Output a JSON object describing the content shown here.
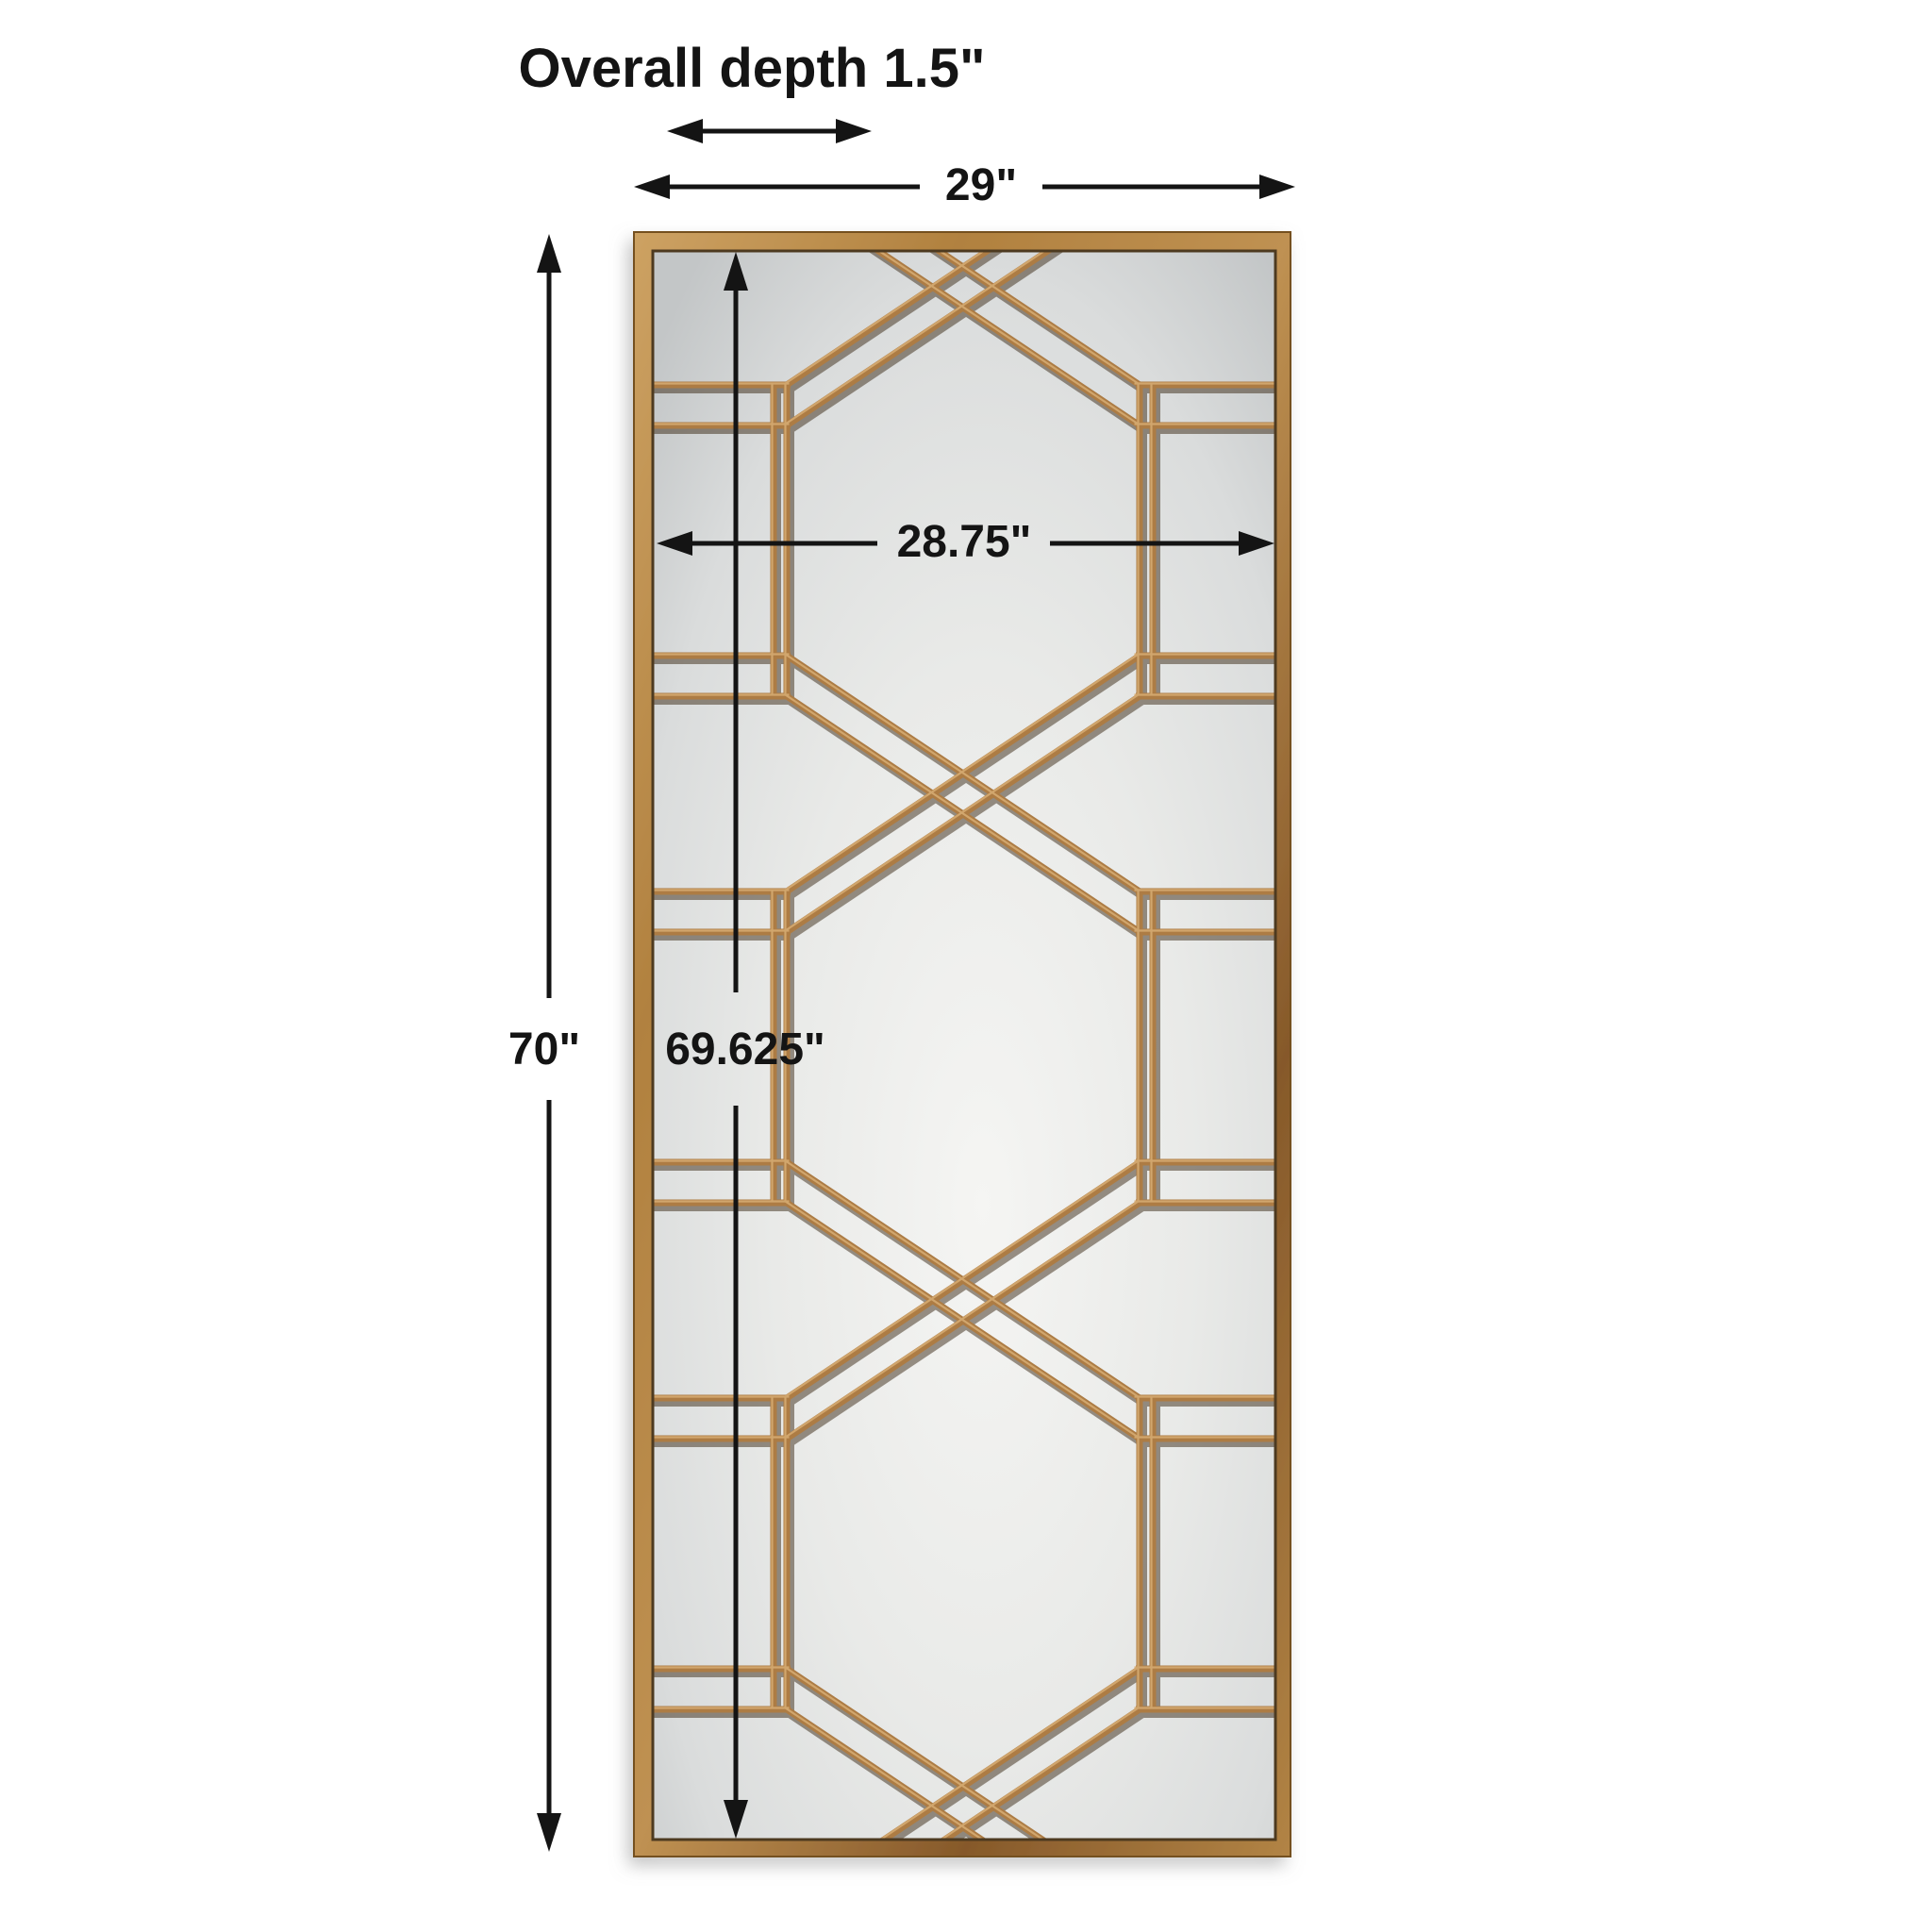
{
  "title": "Overall depth 1.5\"",
  "dimension_labels": {
    "overall_width": "29\"",
    "inner_width": "28.75\"",
    "overall_height": "70\"",
    "inner_height": "69.625\""
  },
  "colors": {
    "background": "#ffffff",
    "ink": "#141414",
    "frame_gold": "#b1813f",
    "frame_gold_light": "#cda263",
    "frame_gold_dark": "#86592a",
    "lattice_gold": "#ad7c44",
    "lattice_gold_light": "#d6ab72",
    "lattice_shadow": "#3b2a16",
    "mirror_light": "#f5f5f3",
    "mirror_mid": "#e9eae8",
    "mirror_dark": "#c3c6c7",
    "drop_shadow": "#8c8c8c"
  }
}
